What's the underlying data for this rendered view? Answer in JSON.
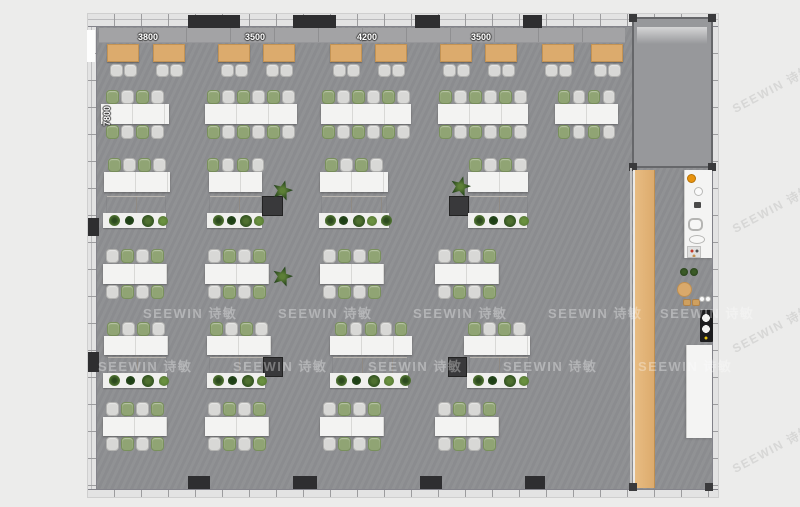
{
  "watermark": {
    "text": "SEEWIN 诗敏",
    "floor_rows": [
      {
        "y": 303,
        "xs": [
          143,
          278,
          413,
          548,
          660
        ]
      },
      {
        "y": 356,
        "xs": [
          98,
          233,
          368,
          503,
          638
        ]
      }
    ],
    "margin_marks": [
      {
        "x": 728,
        "y": 80
      },
      {
        "x": 728,
        "y": 200
      },
      {
        "x": 728,
        "y": 320
      },
      {
        "x": 728,
        "y": 440
      }
    ]
  },
  "palette": {
    "background": "#ececeb",
    "floor": "#8e8f92",
    "room_floor": "#97989b",
    "wall_band": "#e3e3e3",
    "wall_line": "#8f8f91",
    "tick": "#9c9c9e",
    "column": "#2e2e30",
    "bench": "#a3a3a5",
    "wood": "#dcab6d",
    "wood_light": "#e8bc82",
    "table_white": "#f3f3f2",
    "table_seam": "#d8d8d6",
    "booth_table": "#dcab6d",
    "chair_gray": "#d8d8d6",
    "chair_gray_border": "#b3b3b1",
    "chair_green": "#90a474",
    "chair_green_border": "#79905c",
    "cabinet": "#a49f99",
    "cabinet_dark": "#39393b",
    "planter": "#f0f0ee",
    "counter": "#f4f4f3",
    "orange": "#e8930f",
    "appliance_black": "#1c1c1e",
    "plant_dark": "#27461d",
    "plant_mid": "#4f7030",
    "plant_light": "#6a9140"
  },
  "plan": {
    "building": {
      "x": 88,
      "y": 14,
      "w": 630,
      "h": 483
    },
    "dims_top": [
      {
        "label": "3800",
        "cx": 148,
        "cy": 37
      },
      {
        "label": "3500",
        "cx": 255,
        "cy": 37
      },
      {
        "label": "4200",
        "cx": 367,
        "cy": 37
      },
      {
        "label": "3500",
        "cx": 481,
        "cy": 37
      }
    ],
    "dim_left": {
      "label": "7800",
      "cx": 107,
      "cy": 116
    },
    "room": {
      "x": 632,
      "y": 17,
      "w": 81,
      "h": 151
    },
    "door_gap": {
      "x": 87,
      "y": 30,
      "w": 8,
      "h": 32
    },
    "top_columns": [
      {
        "x": 188,
        "w": 52
      },
      {
        "x": 293,
        "w": 43
      },
      {
        "x": 415,
        "w": 25
      },
      {
        "x": 523,
        "w": 19
      }
    ],
    "bottom_columns": [
      {
        "x": 188,
        "w": 22
      },
      {
        "x": 293,
        "w": 24
      },
      {
        "x": 420,
        "w": 22
      },
      {
        "x": 525,
        "w": 20
      }
    ],
    "left_columns": [
      {
        "y": 218,
        "h": 18
      },
      {
        "y": 352,
        "h": 20
      }
    ],
    "bench": {
      "x": 99,
      "y": 28,
      "w": 526,
      "h": 15
    },
    "booth_tables": [
      107,
      153,
      218,
      263,
      330,
      375,
      440,
      485,
      542,
      591
    ],
    "row2_tables": [
      {
        "x": 101,
        "w": 68,
        "n": 4
      },
      {
        "x": 205,
        "w": 92,
        "n": 6
      },
      {
        "x": 321,
        "w": 90,
        "n": 6
      },
      {
        "x": 438,
        "w": 90,
        "n": 6
      },
      {
        "x": 555,
        "w": 63,
        "n": 4
      }
    ],
    "row3_tables": [
      {
        "x": 104,
        "w": 66,
        "n": 4
      },
      {
        "x": 209,
        "w": 53,
        "n": 4
      },
      {
        "x": 320,
        "w": 68,
        "n": 4
      },
      {
        "x": 468,
        "w": 60,
        "n": 4
      }
    ],
    "row3_cabinets": [
      {
        "x": 107,
        "w": 58
      },
      {
        "x": 210,
        "w": 51
      },
      {
        "x": 322,
        "w": 64
      },
      {
        "x": 470,
        "w": 57
      }
    ],
    "row3_planters": [
      {
        "x": 103,
        "w": 63,
        "n": 4
      },
      {
        "x": 207,
        "w": 55,
        "n": 4
      },
      {
        "x": 319,
        "w": 70,
        "n": 5
      },
      {
        "x": 468,
        "w": 59,
        "n": 4
      }
    ],
    "row3_dark_cabinets": [
      {
        "x": 262,
        "w": 21
      },
      {
        "x": 449,
        "w": 20
      }
    ],
    "row3_plants": [
      [
        272,
        180
      ],
      [
        450,
        176
      ]
    ],
    "row4_clusters": {
      "xs": [
        103,
        205,
        320,
        435
      ],
      "w": 64,
      "n": 4
    },
    "row4_plant": [
      272,
      266
    ],
    "row5_tables": [
      {
        "x": 104,
        "w": 64,
        "n": 4
      },
      {
        "x": 207,
        "w": 64,
        "n": 4
      },
      {
        "x": 330,
        "w": 82,
        "n": 5
      },
      {
        "x": 464,
        "w": 66,
        "n": 4
      }
    ],
    "row5_cabinets": [
      {
        "x": 108,
        "w": 58
      },
      {
        "x": 210,
        "w": 56
      },
      {
        "x": 333,
        "w": 74
      },
      {
        "x": 470,
        "w": 58
      }
    ],
    "row5_planters": [
      {
        "x": 103,
        "w": 64,
        "n": 4
      },
      {
        "x": 207,
        "w": 58,
        "n": 4
      },
      {
        "x": 330,
        "w": 78,
        "n": 5
      },
      {
        "x": 467,
        "w": 60,
        "n": 4
      }
    ],
    "row5_dark_cabinets": [
      {
        "x": 263,
        "w": 20
      },
      {
        "x": 448,
        "w": 19
      }
    ],
    "row6_clusters": {
      "xs": [
        103,
        205,
        320,
        435
      ],
      "w": 64,
      "n": 4
    },
    "wood_walkway": {
      "x": 633,
      "y": 170,
      "w": 22,
      "h": 318
    },
    "corridor_posts": [
      [
        629,
        483
      ],
      [
        705,
        483
      ]
    ],
    "pantry": {
      "counters": [
        {
          "x": 684,
          "y": 170,
          "w": 28,
          "h": 88
        },
        {
          "x": 686,
          "y": 345,
          "w": 26,
          "h": 93
        }
      ],
      "items": [
        {
          "t": "orange",
          "x": 687,
          "y": 174,
          "s": 9
        },
        {
          "t": "ring",
          "x": 694,
          "y": 187,
          "s": 9
        },
        {
          "t": "dark",
          "x": 694,
          "y": 202,
          "w": 7,
          "h": 6
        },
        {
          "t": "sink",
          "x": 688,
          "y": 218,
          "w": 15,
          "h": 13
        },
        {
          "t": "oval",
          "x": 689,
          "y": 235,
          "w": 16,
          "h": 9
        },
        {
          "t": "panel",
          "x": 687,
          "y": 246,
          "w": 14,
          "h": 12
        },
        {
          "t": "plantdot",
          "x": 680,
          "y": 268,
          "s": 8
        },
        {
          "t": "plantdot",
          "x": 690,
          "y": 268,
          "s": 8
        },
        {
          "t": "roundtable",
          "x": 677,
          "y": 282,
          "s": 15
        },
        {
          "t": "stool",
          "x": 683,
          "y": 299,
          "w": 8,
          "h": 7
        },
        {
          "t": "stool",
          "x": 692,
          "y": 299,
          "w": 8,
          "h": 7
        },
        {
          "t": "ring",
          "x": 699,
          "y": 296,
          "s": 6
        },
        {
          "t": "ring",
          "x": 705,
          "y": 296,
          "s": 6
        },
        {
          "t": "cooktop",
          "x": 700,
          "y": 310,
          "w": 13,
          "h": 32
        }
      ]
    }
  }
}
